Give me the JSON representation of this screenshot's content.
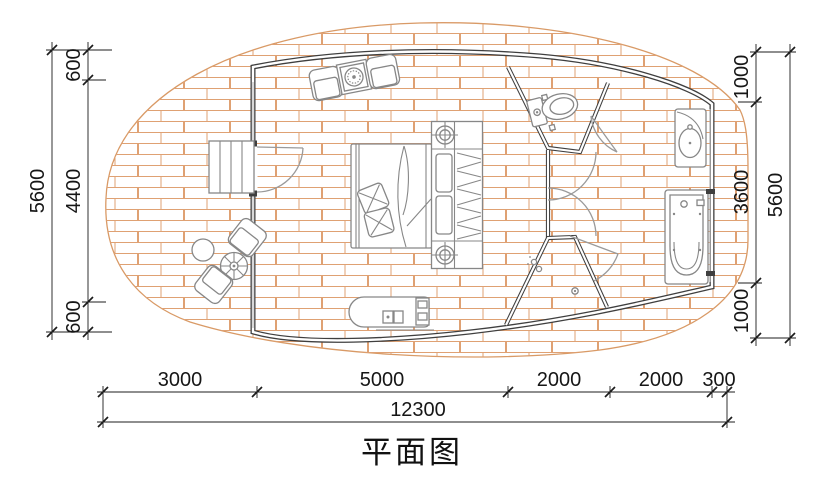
{
  "title": {
    "text": "平面图"
  },
  "dimensions": {
    "left": {
      "segments": [
        "600",
        "4400",
        "600"
      ],
      "total": "5600"
    },
    "right": {
      "segments": [
        "1000",
        "3600",
        "1000"
      ],
      "total": "5600"
    },
    "bottom": {
      "segments": [
        "3000",
        "5000",
        "2000",
        "2000",
        "300"
      ],
      "total": "12300"
    }
  },
  "colors": {
    "brick_line": "#dfa173",
    "deck_outline": "#d99a66",
    "wall": "#3f3f3f",
    "furniture": "#878787",
    "door": "#9a9a9a",
    "dimension": "#1c1c1c",
    "background": "#ffffff"
  },
  "fixtures": [
    "deck",
    "steps",
    "entry-door",
    "bed",
    "pillows",
    "wardrobe",
    "armchairs",
    "coffee-table",
    "bench",
    "outdoor-chairs",
    "outdoor-round-table",
    "parasol-table",
    "toilet",
    "washbasin",
    "bathtub",
    "shower-drain",
    "shower-head",
    "ceiling-lamp"
  ]
}
